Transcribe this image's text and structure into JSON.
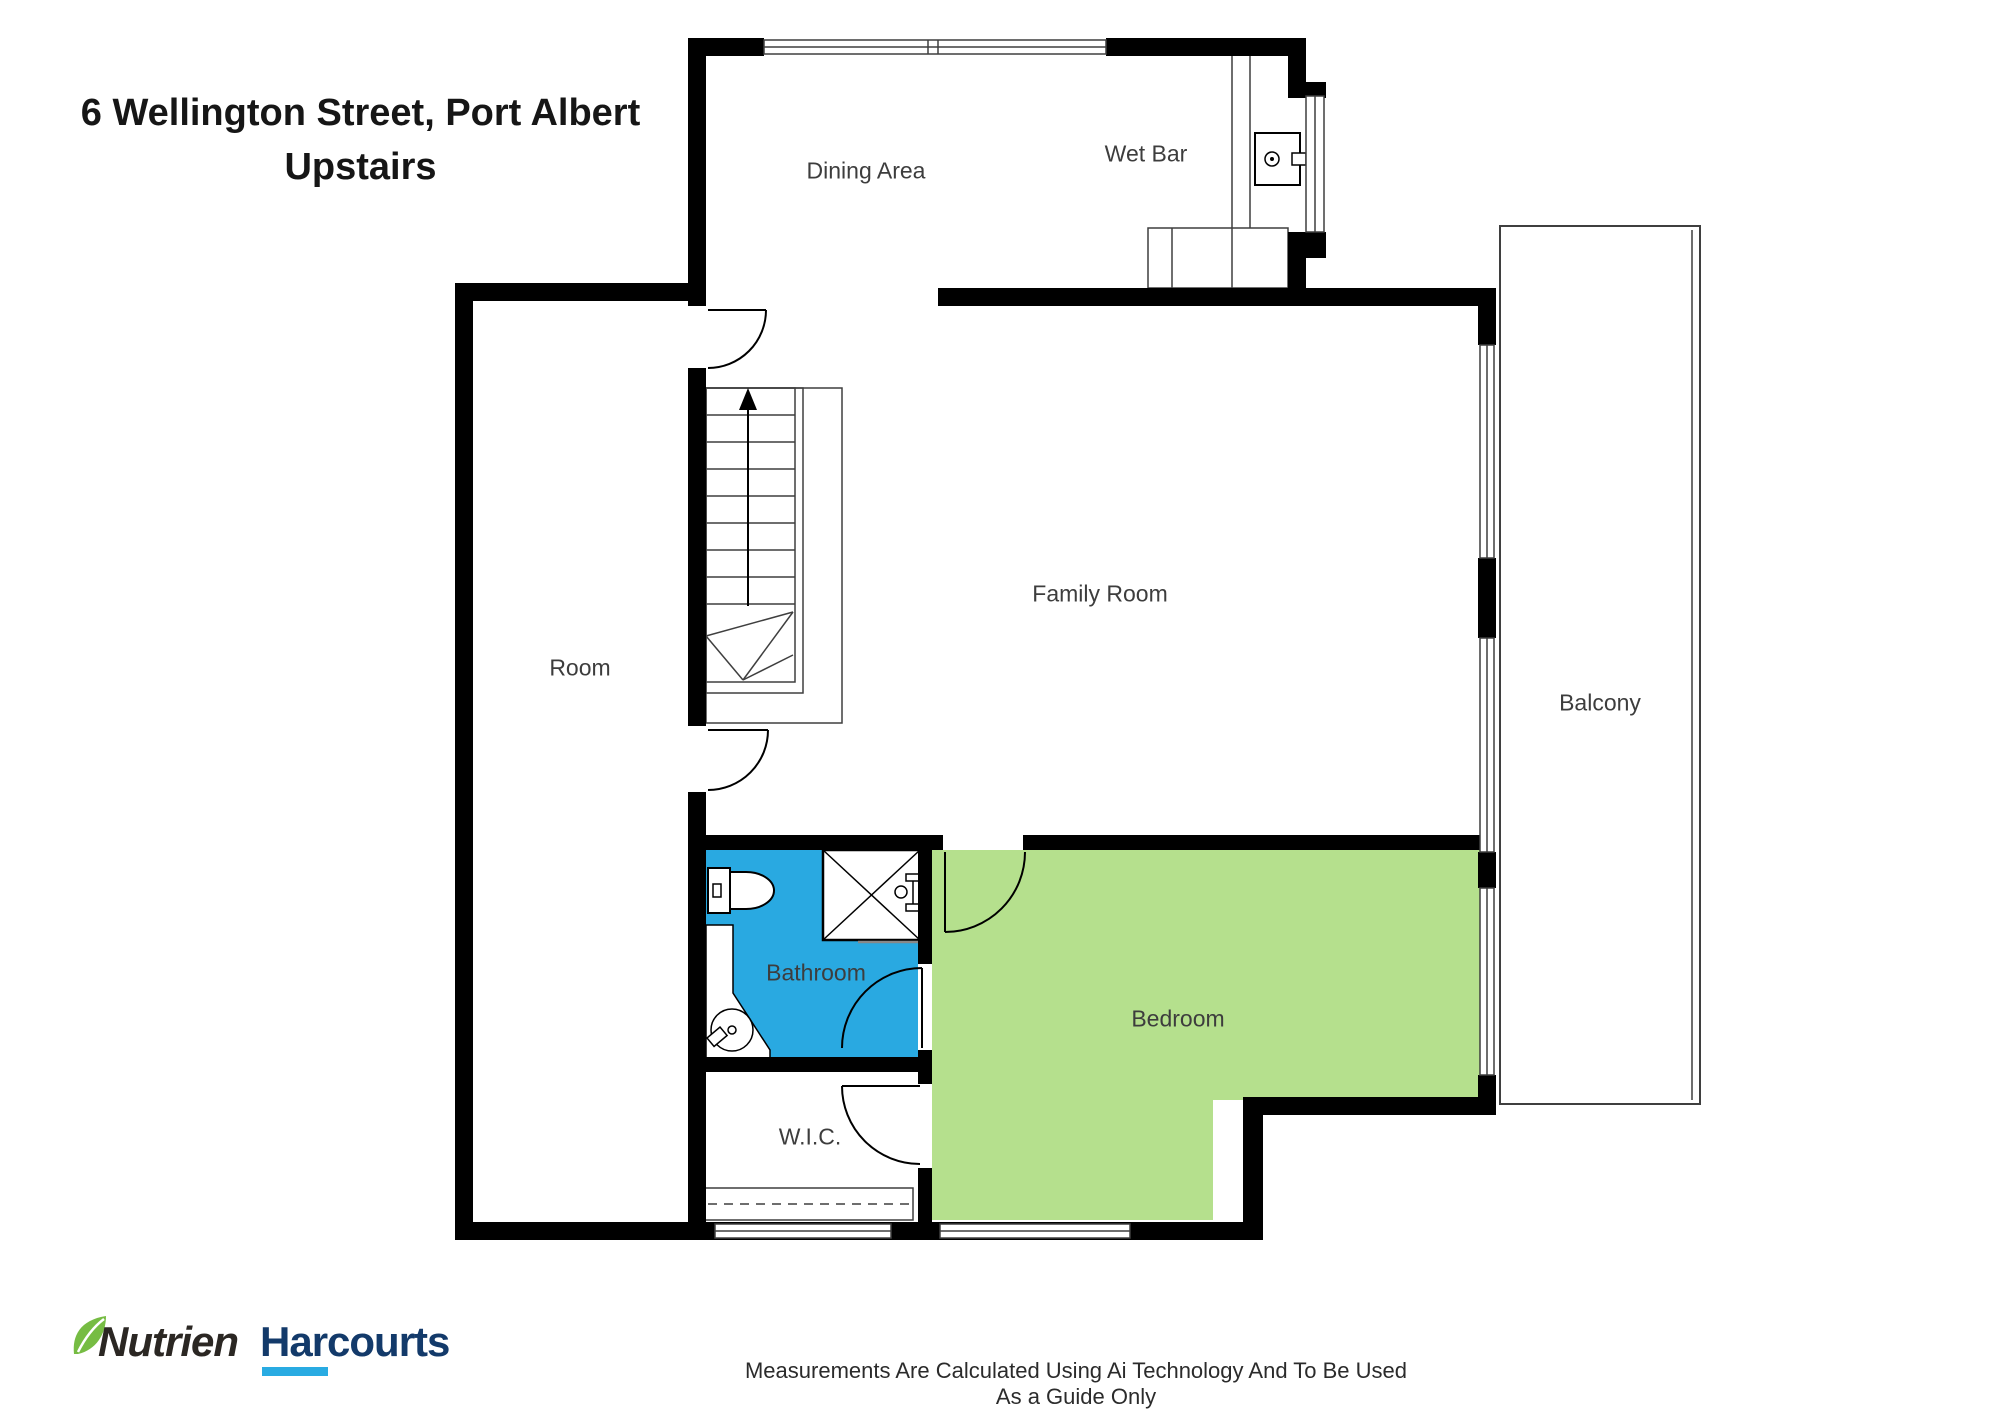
{
  "title": {
    "line1": "6 Wellington Street, Port Albert",
    "line2": "Upstairs"
  },
  "rooms": {
    "dining": {
      "label": "Dining Area"
    },
    "wet_bar": {
      "label": "Wet Bar"
    },
    "family": {
      "label": "Family Room"
    },
    "room": {
      "label": "Room"
    },
    "balcony": {
      "label": "Balcony"
    },
    "bathroom": {
      "label": "Bathroom"
    },
    "bedroom": {
      "label": "Bedroom"
    },
    "wic": {
      "label": "W.I.C."
    }
  },
  "colors": {
    "bathroom_fill": "#29a9e1",
    "bedroom_fill": "#b5e08d",
    "wall": "#000000",
    "logo_green": "#76bc43",
    "logo_navy": "#133a6a",
    "logo_cyan": "#29abe2",
    "logo_dark": "#2b2723"
  },
  "logo": {
    "brand1": "Nutrien",
    "brand2": "Harcourts"
  },
  "footer": {
    "disclaimer": "Measurements Are Calculated Using Ai Technology And To Be Used As a Guide Only"
  }
}
